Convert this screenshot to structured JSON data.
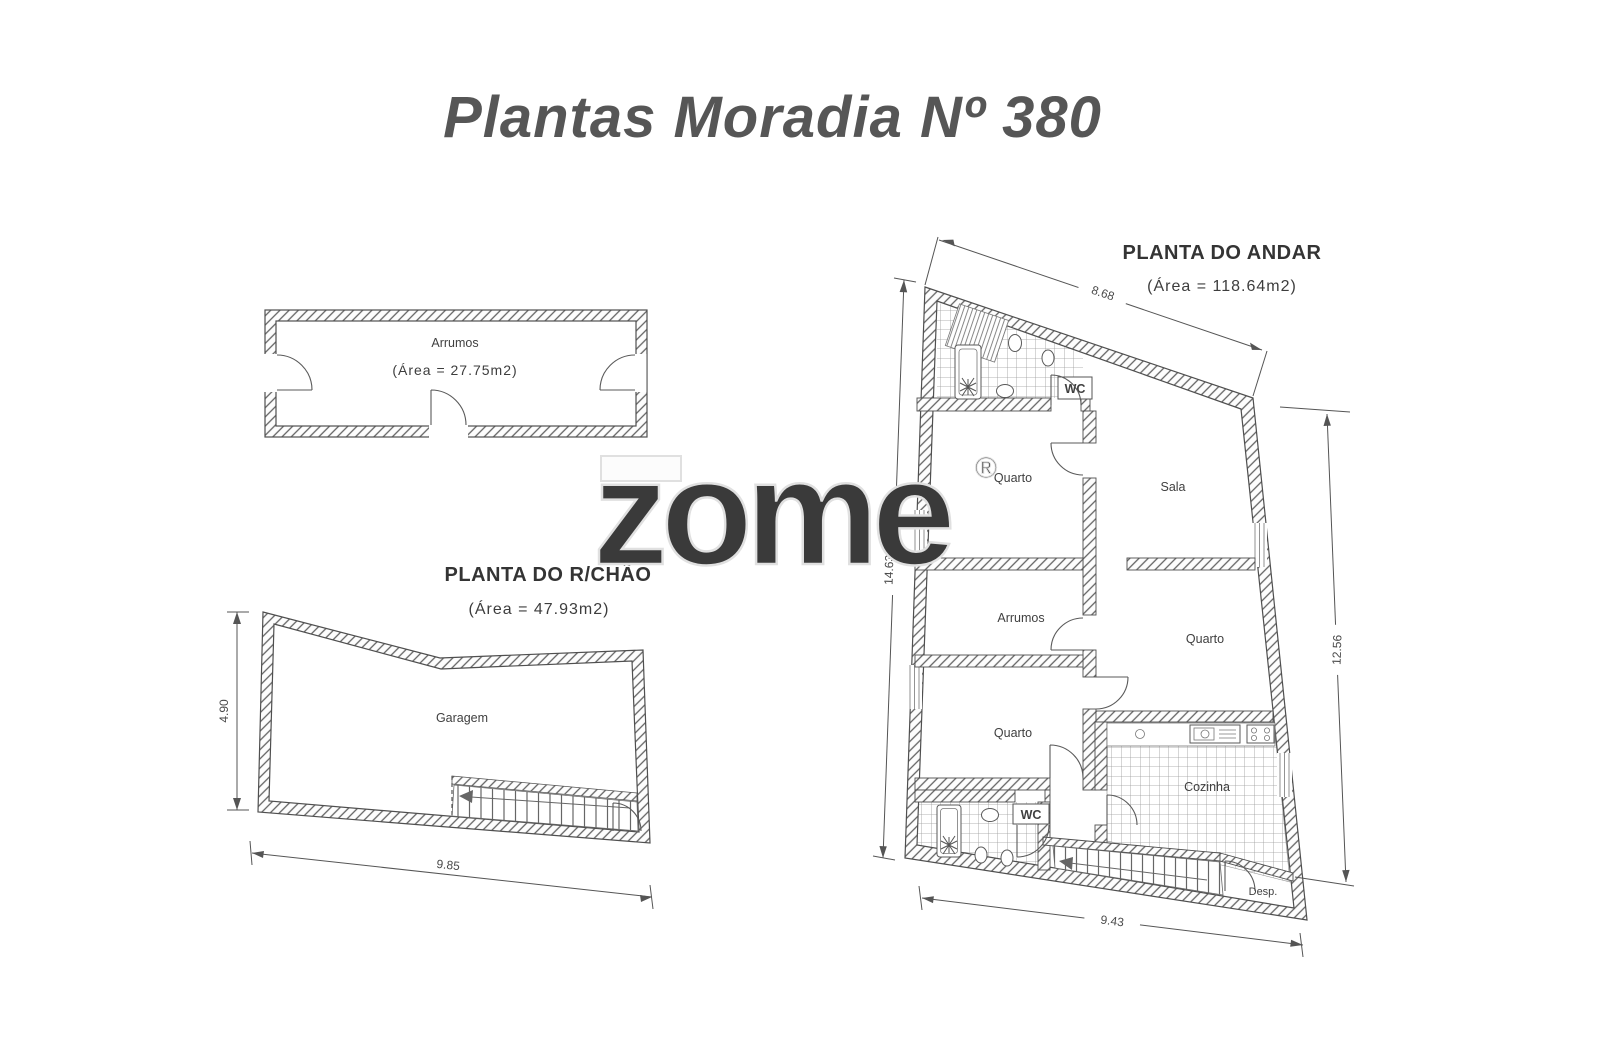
{
  "page": {
    "title": "Plantas Moradia Nº 380",
    "watermark": {
      "text": "zome",
      "reg": "®"
    }
  },
  "annex_plan": {
    "room_label": "Arrumos",
    "area_label": "(Área  =  27.75m2)"
  },
  "ground_floor_plan": {
    "title": "PLANTA DO R/CHÃO",
    "area_label": "(Área  =  47.93m2)",
    "room_label": "Garagem",
    "dims": {
      "left": "4.90",
      "bottom": "9.85"
    }
  },
  "upper_floor_plan": {
    "title": "PLANTA DO ANDAR",
    "area_label": "(Área  =  118.64m2)",
    "rooms": {
      "wc_top": "WC",
      "quarto_top_left": "Quarto",
      "sala": "Sala",
      "arrumos": "Arrumos",
      "quarto_mid_left": "Quarto",
      "quarto_right": "Quarto",
      "cozinha": "Cozinha",
      "wc_bottom": "WC",
      "despensa": "Desp."
    },
    "dims": {
      "top": "8.68",
      "left": "14.63",
      "right": "12.56",
      "bottom": "9.43"
    }
  },
  "colors": {
    "ink": "#4f4f4f",
    "page_title_ink": "#565656",
    "watermark_outline": "#e0e0e0"
  }
}
